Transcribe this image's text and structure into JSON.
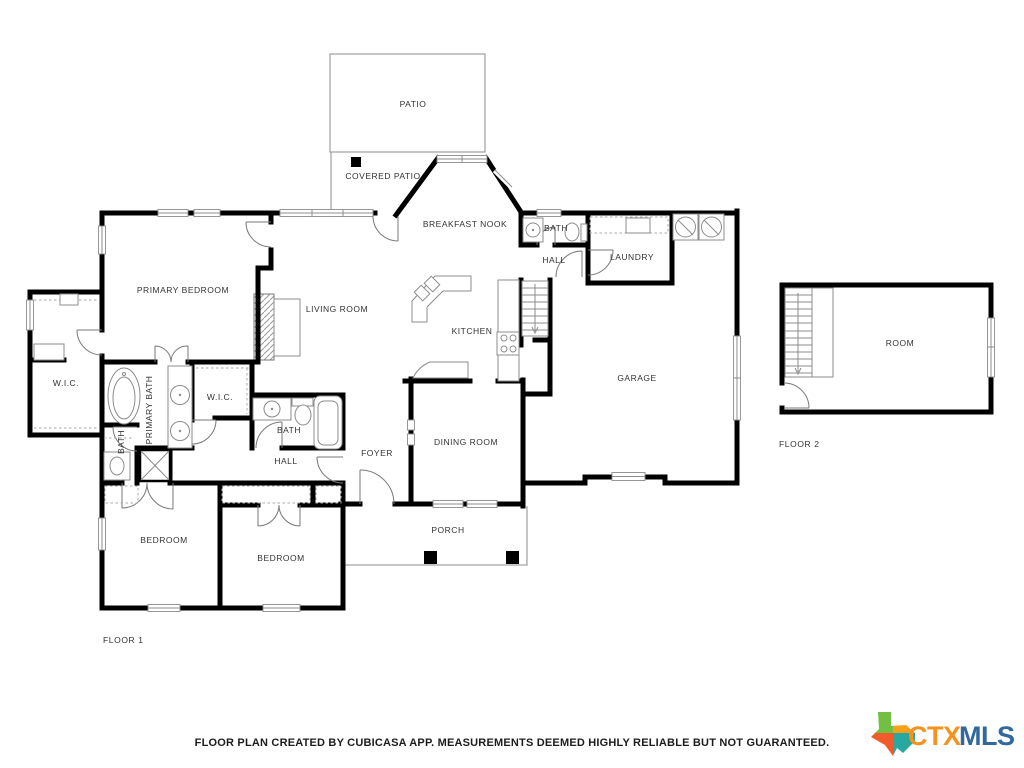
{
  "plan": {
    "wall_color": "#000000",
    "fixture_line_color": "#8c8c8c",
    "text_color": "#333333",
    "background": "#ffffff"
  },
  "floor1": {
    "label": "FLOOR 1",
    "rooms": [
      {
        "label": "PATIO"
      },
      {
        "label": "COVERED PATIO"
      },
      {
        "label": "BREAKFAST NOOK"
      },
      {
        "label": "BATH"
      },
      {
        "label": "HALL"
      },
      {
        "label": "LAUNDRY"
      },
      {
        "label": "PRIMARY BEDROOM"
      },
      {
        "label": "LIVING ROOM"
      },
      {
        "label": "KITCHEN"
      },
      {
        "label": "GARAGE"
      },
      {
        "label": "W.I.C."
      },
      {
        "label": "PRIMARY BATH"
      },
      {
        "label": "W.I.C."
      },
      {
        "label": "BATH"
      },
      {
        "label": "BATH"
      },
      {
        "label": "HALL"
      },
      {
        "label": "FOYER"
      },
      {
        "label": "DINING ROOM"
      },
      {
        "label": "PORCH"
      },
      {
        "label": "BEDROOM"
      },
      {
        "label": "BEDROOM"
      }
    ]
  },
  "floor2": {
    "label": "FLOOR 2",
    "rooms": [
      {
        "label": "ROOM"
      }
    ]
  },
  "footer": {
    "disclaimer": "FLOOR PLAN CREATED BY CUBICASA APP. MEASUREMENTS DEEMED HIGHLY RELIABLE BUT NOT GUARANTEED."
  },
  "logo": {
    "ctx": "CTX",
    "mls": "MLS",
    "colors": {
      "ctx": "#F6921E",
      "mls": "#31699E",
      "texas_green": "#72BF44",
      "texas_orange": "#F9A01B",
      "texas_red": "#F15A29",
      "texas_teal": "#28A8A0"
    }
  }
}
